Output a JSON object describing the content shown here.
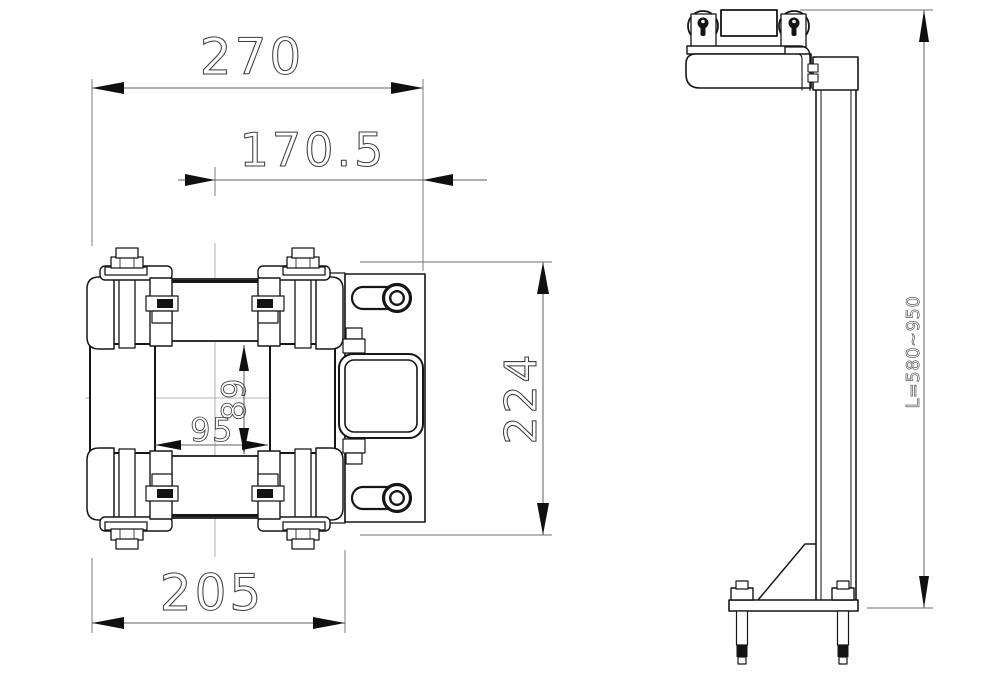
{
  "drawing": {
    "background": "#ffffff",
    "line_color": "#161616",
    "dimension_color": "#3d3d3d",
    "views": {
      "front": {
        "dims": {
          "overall_width": "270",
          "center_to_plate_edge": "170.5",
          "bottom_width": "205",
          "overall_height": "224",
          "vertical_roller_gap": "89",
          "horizontal_roller_gap": "95"
        }
      },
      "side": {
        "dims": {
          "mast_length": "L=580~950"
        }
      }
    }
  }
}
